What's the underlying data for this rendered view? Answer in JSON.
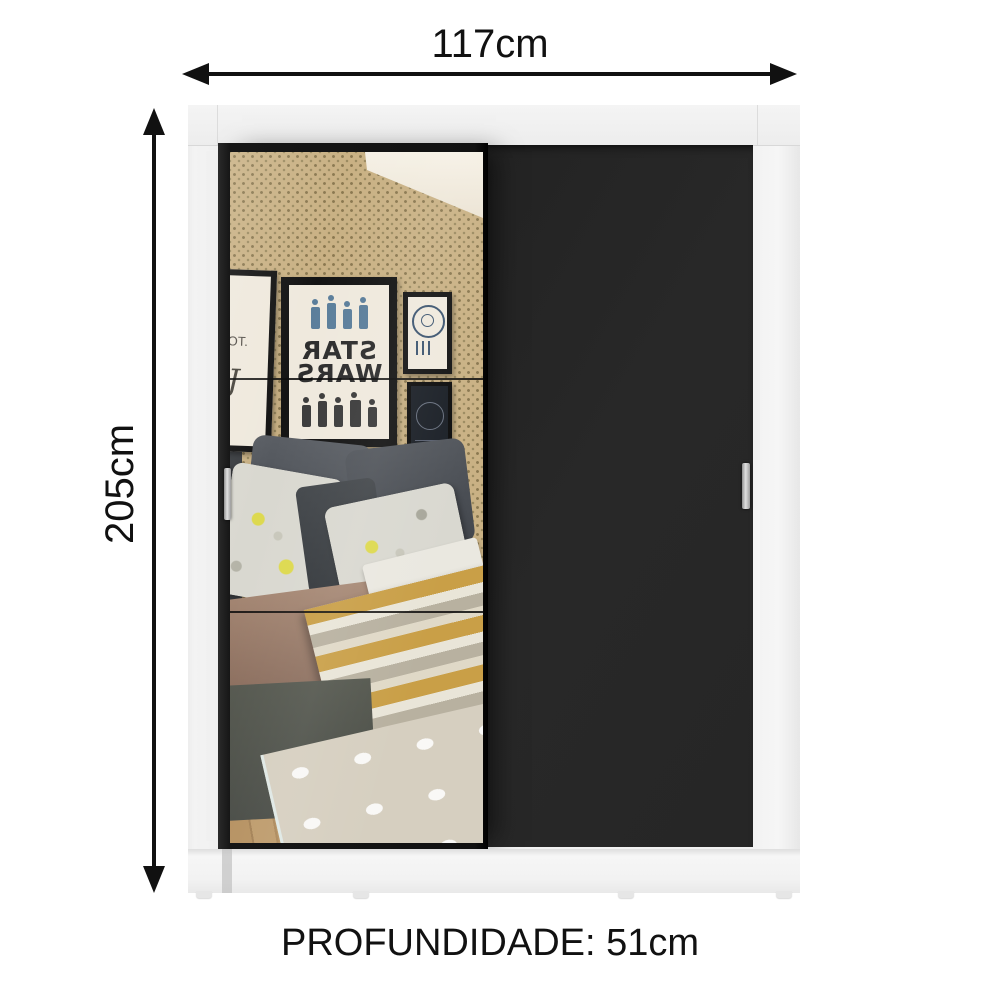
{
  "dimensions": {
    "width": {
      "label": "117cm"
    },
    "height": {
      "label": "205cm"
    },
    "depth": {
      "label": "PROFUNDIDADE: 51cm"
    }
  },
  "wardrobe": {
    "cabinet_color": "#f1f1f1",
    "doors": [
      {
        "type": "mirror-sliding-door",
        "position": "left",
        "frame_color": "#161616"
      },
      {
        "type": "panel-sliding-door",
        "position": "right",
        "color": "#272727"
      }
    ],
    "handle_color": "#c8c8c8"
  },
  "mirror_reflection": {
    "wallpaper_color": "#c9b184",
    "posters": {
      "star_wars_line1": "STAR",
      "star_wars_line2": "WARS",
      "partial_text": "OT.",
      "partial_glyph": "J"
    }
  },
  "colors": {
    "arrow": "#111111",
    "text": "#111111",
    "background": "#ffffff"
  }
}
